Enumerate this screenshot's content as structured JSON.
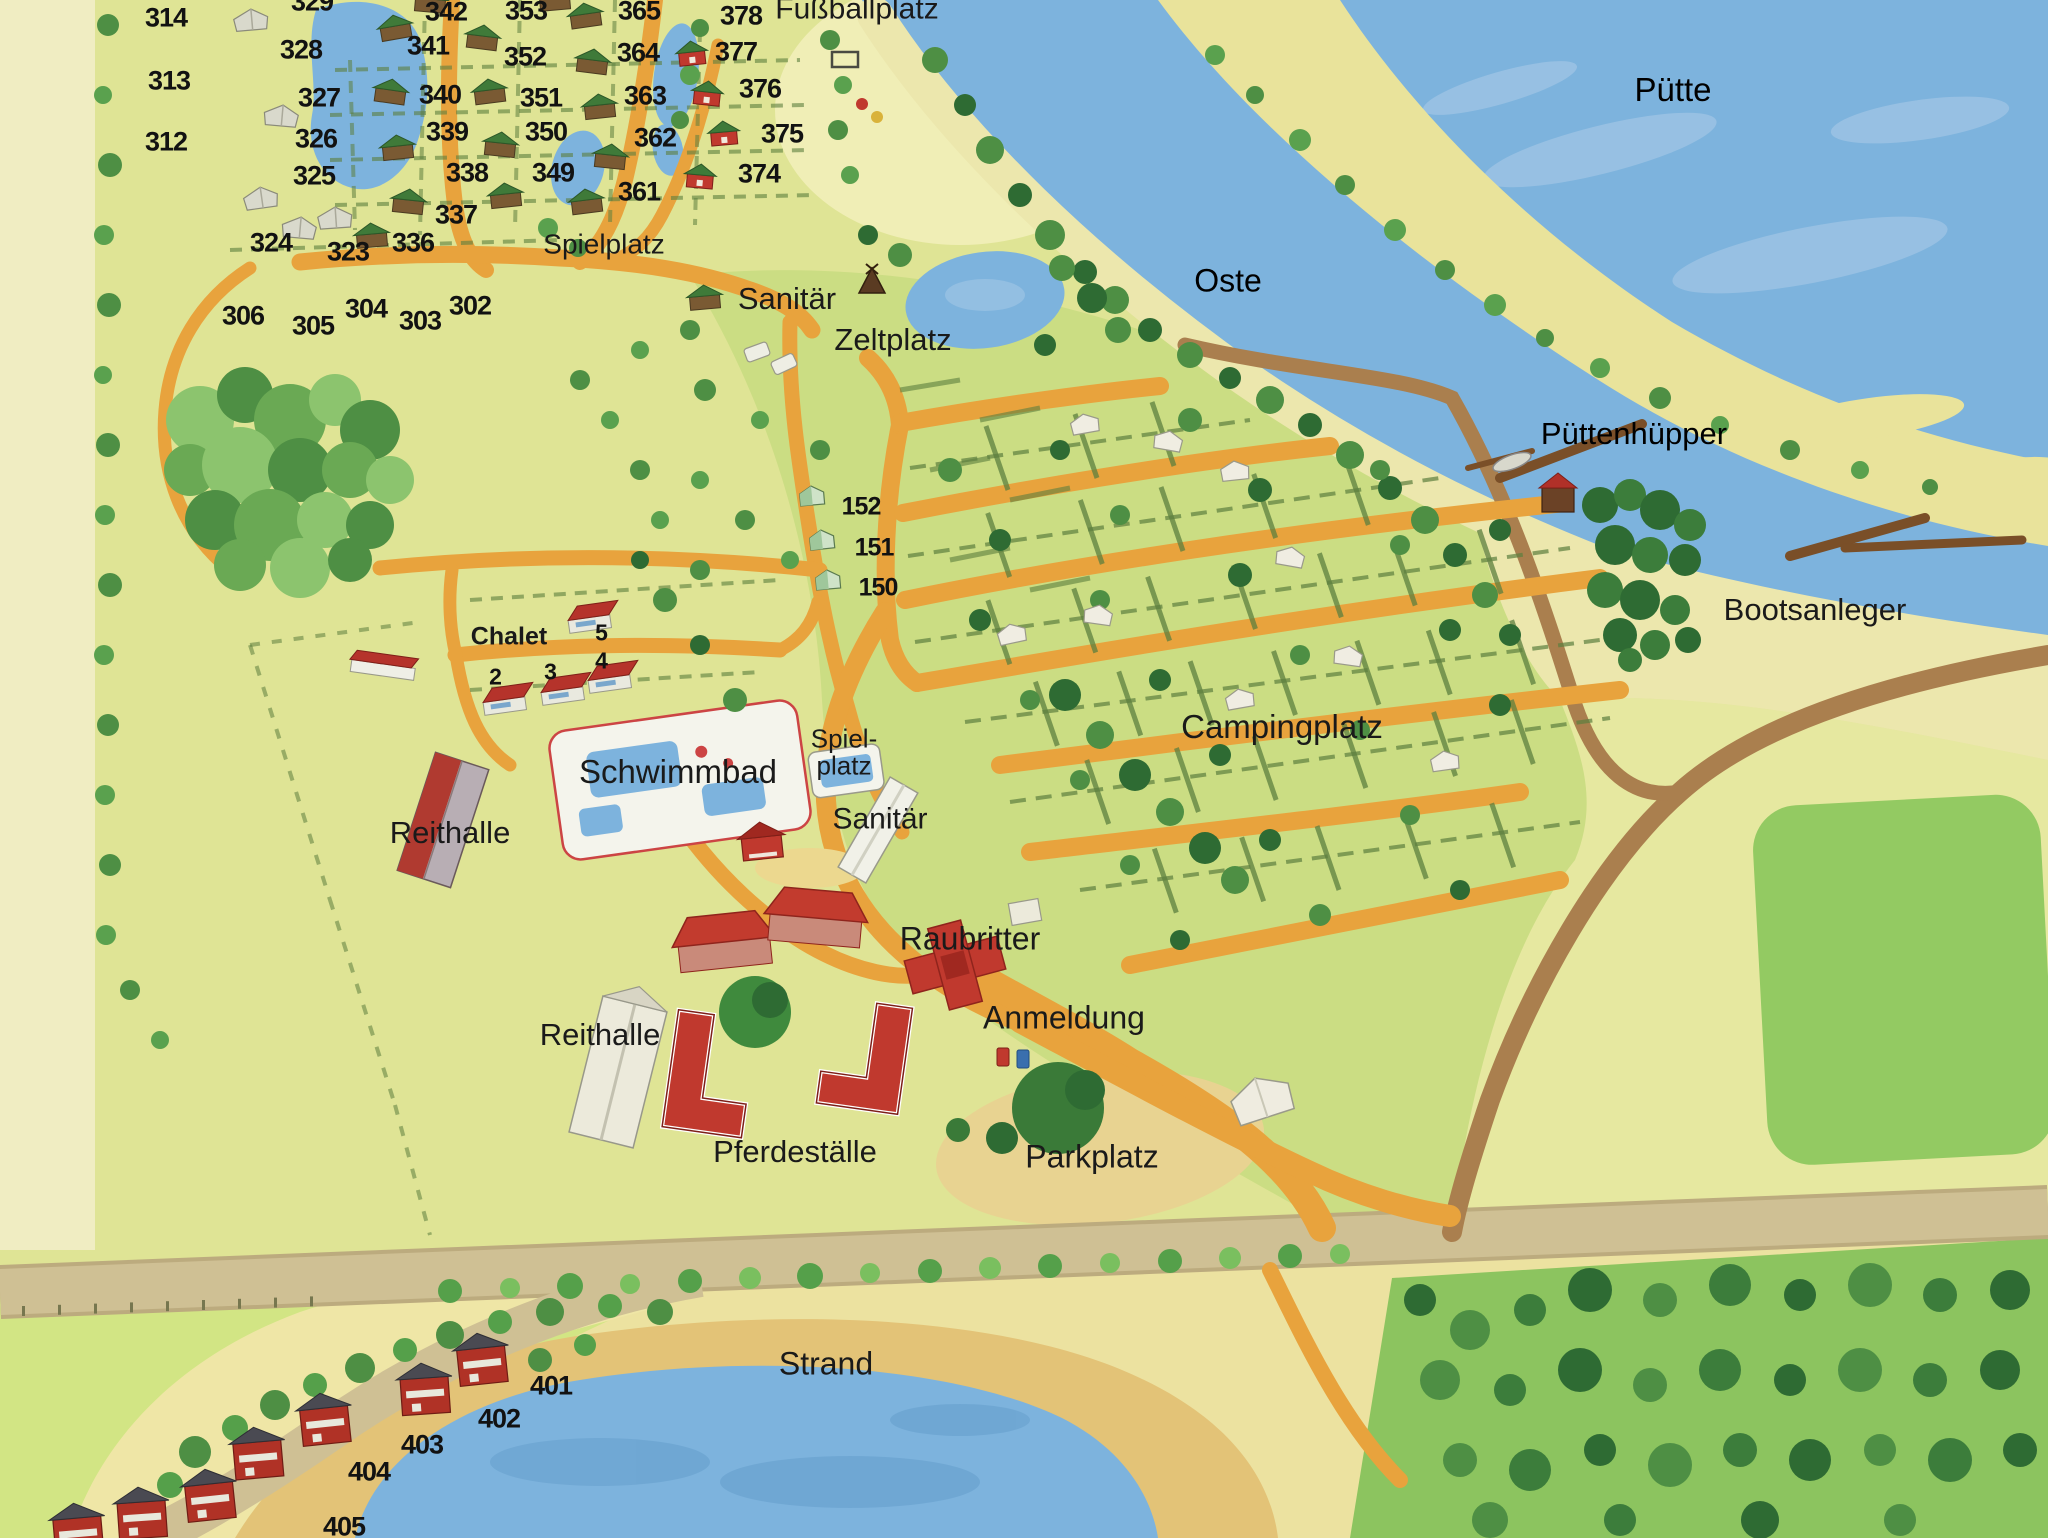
{
  "map": {
    "title": "Campingplatz Übersichtsplan",
    "region_labels": [
      {
        "id": "fussballplatz",
        "text": "Fußballplatz",
        "x": 857,
        "y": 10,
        "fs": 30,
        "cls": ""
      },
      {
        "id": "spielplatz-north",
        "text": "Spielplatz",
        "x": 604,
        "y": 245,
        "fs": 28,
        "cls": ""
      },
      {
        "id": "sanitaer-north",
        "text": "Sanitär",
        "x": 787,
        "y": 299,
        "fs": 31,
        "cls": ""
      },
      {
        "id": "zeltplatz",
        "text": "Zeltplatz",
        "x": 893,
        "y": 340,
        "fs": 31,
        "cls": ""
      },
      {
        "id": "puette",
        "text": "Pütte",
        "x": 1673,
        "y": 90,
        "fs": 33,
        "cls": "water"
      },
      {
        "id": "oste",
        "text": "Oste",
        "x": 1228,
        "y": 281,
        "fs": 32,
        "cls": "water"
      },
      {
        "id": "puettenhuepper",
        "text": "Püttenhüpper",
        "x": 1634,
        "y": 434,
        "fs": 31,
        "cls": "water"
      },
      {
        "id": "bootsanleger",
        "text": "Bootsanleger",
        "x": 1815,
        "y": 610,
        "fs": 31,
        "cls": ""
      },
      {
        "id": "campingplatz",
        "text": "Campingplatz",
        "x": 1282,
        "y": 727,
        "fs": 33,
        "cls": ""
      },
      {
        "id": "chalet-heading",
        "text": "Chalet",
        "x": 509,
        "y": 637,
        "fs": 25,
        "cls": "bold"
      },
      {
        "id": "schwimmbad",
        "text": "Schwimmbad",
        "x": 678,
        "y": 772,
        "fs": 33,
        "cls": ""
      },
      {
        "id": "reithalle-west",
        "text": "Reithalle",
        "x": 450,
        "y": 833,
        "fs": 31,
        "cls": ""
      },
      {
        "id": "spielplatz-south",
        "text": "Spiel-\nplatz",
        "x": 844,
        "y": 752,
        "fs": 26,
        "cls": ""
      },
      {
        "id": "sanitaer-south",
        "text": "Sanitär",
        "x": 880,
        "y": 820,
        "fs": 30,
        "cls": ""
      },
      {
        "id": "raubritter",
        "text": "Raubritter",
        "x": 970,
        "y": 939,
        "fs": 32,
        "cls": ""
      },
      {
        "id": "anmeldung",
        "text": "Anmeldung",
        "x": 1064,
        "y": 1018,
        "fs": 32,
        "cls": ""
      },
      {
        "id": "reithalle-south",
        "text": "Reithalle",
        "x": 600,
        "y": 1035,
        "fs": 31,
        "cls": ""
      },
      {
        "id": "pferdestaelle",
        "text": "Pferdeställe",
        "x": 795,
        "y": 1152,
        "fs": 31,
        "cls": ""
      },
      {
        "id": "parkplatz",
        "text": "Parkplatz",
        "x": 1092,
        "y": 1157,
        "fs": 32,
        "cls": ""
      },
      {
        "id": "strand",
        "text": "Strand",
        "x": 826,
        "y": 1364,
        "fs": 32,
        "cls": ""
      }
    ],
    "plot_numbers": [
      {
        "n": "314",
        "x": 166,
        "y": 18
      },
      {
        "n": "313",
        "x": 169,
        "y": 81
      },
      {
        "n": "312",
        "x": 166,
        "y": 142
      },
      {
        "n": "329",
        "x": 312,
        "y": 2
      },
      {
        "n": "328",
        "x": 301,
        "y": 50
      },
      {
        "n": "327",
        "x": 319,
        "y": 98
      },
      {
        "n": "326",
        "x": 316,
        "y": 139
      },
      {
        "n": "325",
        "x": 314,
        "y": 176
      },
      {
        "n": "324",
        "x": 271,
        "y": 243
      },
      {
        "n": "323",
        "x": 348,
        "y": 252
      },
      {
        "n": "342",
        "x": 446,
        "y": 12
      },
      {
        "n": "341",
        "x": 428,
        "y": 46
      },
      {
        "n": "340",
        "x": 440,
        "y": 95
      },
      {
        "n": "339",
        "x": 447,
        "y": 132
      },
      {
        "n": "338",
        "x": 467,
        "y": 173
      },
      {
        "n": "337",
        "x": 456,
        "y": 215
      },
      {
        "n": "336",
        "x": 413,
        "y": 243
      },
      {
        "n": "353",
        "x": 526,
        "y": 11
      },
      {
        "n": "352",
        "x": 525,
        "y": 57
      },
      {
        "n": "351",
        "x": 541,
        "y": 98
      },
      {
        "n": "350",
        "x": 546,
        "y": 132
      },
      {
        "n": "349",
        "x": 553,
        "y": 173
      },
      {
        "n": "365",
        "x": 639,
        "y": 11
      },
      {
        "n": "364",
        "x": 638,
        "y": 53
      },
      {
        "n": "363",
        "x": 645,
        "y": 96
      },
      {
        "n": "362",
        "x": 655,
        "y": 138
      },
      {
        "n": "361",
        "x": 639,
        "y": 192
      },
      {
        "n": "378",
        "x": 741,
        "y": 16
      },
      {
        "n": "377",
        "x": 736,
        "y": 52
      },
      {
        "n": "376",
        "x": 760,
        "y": 89
      },
      {
        "n": "375",
        "x": 782,
        "y": 134
      },
      {
        "n": "374",
        "x": 759,
        "y": 174
      },
      {
        "n": "306",
        "x": 243,
        "y": 316
      },
      {
        "n": "305",
        "x": 313,
        "y": 326
      },
      {
        "n": "304",
        "x": 366,
        "y": 309
      },
      {
        "n": "303",
        "x": 420,
        "y": 321
      },
      {
        "n": "302",
        "x": 470,
        "y": 306
      },
      {
        "n": "401",
        "x": 551,
        "y": 1386
      },
      {
        "n": "402",
        "x": 499,
        "y": 1419
      },
      {
        "n": "403",
        "x": 422,
        "y": 1445
      },
      {
        "n": "404",
        "x": 369,
        "y": 1472
      },
      {
        "n": "405",
        "x": 344,
        "y": 1527
      }
    ],
    "tent_numbers": [
      {
        "n": "152",
        "x": 861,
        "y": 507
      },
      {
        "n": "151",
        "x": 874,
        "y": 548
      },
      {
        "n": "150",
        "x": 878,
        "y": 588
      }
    ],
    "chalet_numbers": [
      {
        "n": "5",
        "x": 601,
        "y": 633
      },
      {
        "n": "4",
        "x": 601,
        "y": 661
      },
      {
        "n": "3",
        "x": 550,
        "y": 672
      },
      {
        "n": "2",
        "x": 495,
        "y": 677
      }
    ]
  },
  "colors": {
    "base": "#dfe495",
    "camp": "#cbdd83",
    "pale_field": "#f0edc2",
    "fussball_wash": "#f0eeb6",
    "water": "#7db3dd",
    "water_light": "#a6c8e6",
    "water_dark": "#639dcb",
    "sandbar": "#e9e39b",
    "sand": "#ece7ad",
    "beach": "#e3c377",
    "bottom_sand": "#ece2a0",
    "house_sand": "#efe6a6",
    "path_orange": "#e8a33d",
    "road_tan": "#cfc094",
    "road_tan_edge": "#bcab7e",
    "road_brown": "#aa7f4e",
    "pier_brown": "#7a4f28",
    "field_green": "#93ca62",
    "bottom_field": "#d2e584",
    "bright_green": "#8cc45f",
    "forest_dark": "#2e6b33",
    "forest_mid": "#4e8f44",
    "forest_light": "#8cc46e",
    "hedge": "#5d7f3f",
    "building_red": "#c0392e",
    "roof_dark_red": "#8f241c",
    "roof_green": "#3f7a39",
    "roof_gray": "#4a4a52",
    "wall_white": "#f1f1e8",
    "label": "#1a1a1a",
    "water_label": "#1d2b3a"
  }
}
